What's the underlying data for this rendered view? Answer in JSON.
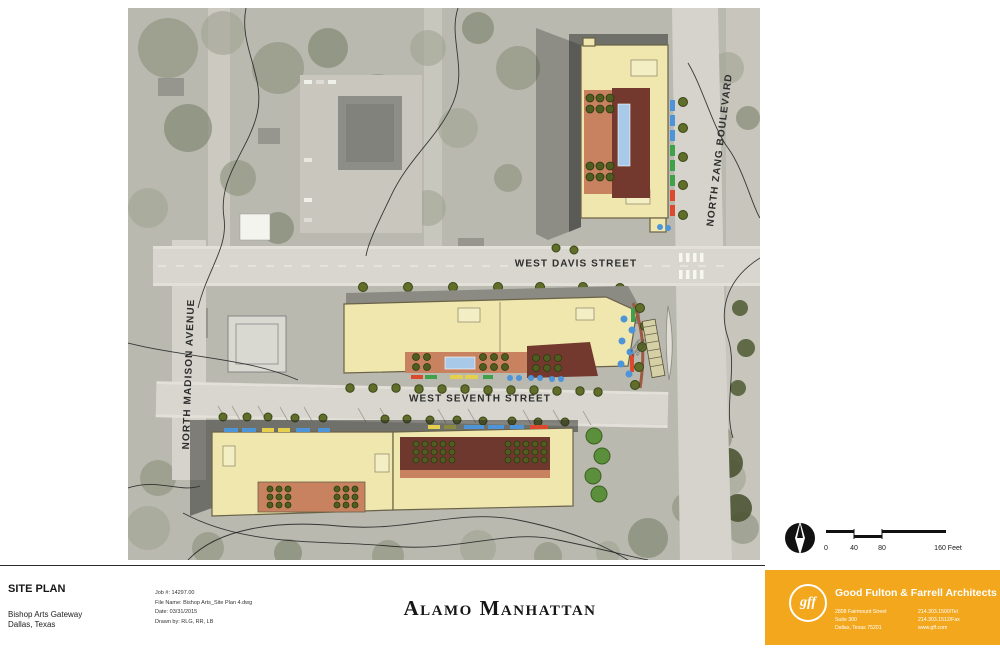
{
  "plan": {
    "streets": {
      "west_davis": "WEST DAVIS STREET",
      "west_seventh": "WEST SEVENTH STREET",
      "north_zang": "NORTH ZANG BOULEVARD",
      "north_madison": "NORTH MADISON AVENUE"
    },
    "station_label_lines": [
      "MODERN",
      "STREETCAR",
      "STATION"
    ]
  },
  "scale": {
    "t0": "0",
    "t40": "40",
    "t80": "80",
    "t160": "160 Feet"
  },
  "titleblock": {
    "sheet_type": "SITE PLAN",
    "project": "Bishop Arts Gateway",
    "location": "Dallas, Texas",
    "job": "Job #: 14297.00",
    "file": "File Name: Bishop Arts_Site Plan 4.dwg",
    "date": "Date: 03/31/2015",
    "drawn": "Drawn by: RLG, RR, LB",
    "title": "Alamo Manhattan"
  },
  "firm": {
    "logo": "gff",
    "name": "Good Fulton & Farrell Architects",
    "addr1": "2808 Fairmount Street",
    "addr2": "Suite 300",
    "addr3": "Dallas, Texas 75201",
    "tel": "214.303.1500/Tel",
    "fax": "214.303.1512/Fax",
    "web": "www.gff.com",
    "brand_color": "#f2a71d"
  },
  "colors": {
    "building": "#efe7ad",
    "courtyard_salmon": "#c9825f",
    "courtyard_brick": "#73392e",
    "pool": "#a9c9e9",
    "street": "#d8d6ce",
    "aerial_base": "#b9b9b0",
    "awning_blue": "#4d94d8",
    "awning_green": "#3fa24b",
    "awning_red": "#db4a2d",
    "awning_yellow": "#e5cf4d"
  }
}
